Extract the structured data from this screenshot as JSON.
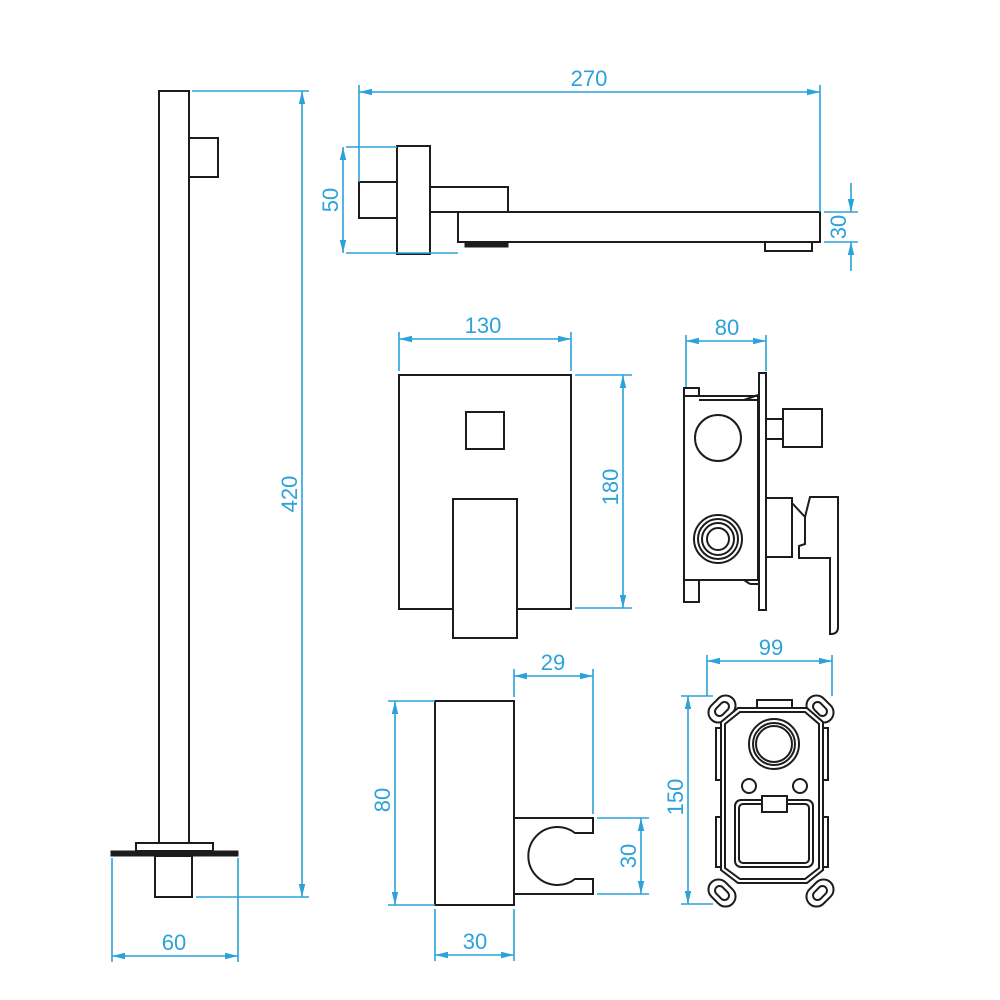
{
  "drawing": {
    "type": "technical-dimension-drawing",
    "subject": "concealed shower faucet set components",
    "units": "mm",
    "colors": {
      "part_line": "#1c1c1c",
      "dimension": "#2ba2d9",
      "background": "#ffffff"
    },
    "views": {
      "shower_arm": {
        "name": "ceiling shower arm side view",
        "dim_height": "420",
        "dim_base_width": "60"
      },
      "spout": {
        "name": "wall spout side view",
        "dim_length": "270",
        "dim_plate_height": "50",
        "dim_thickness": "30"
      },
      "mixer_front": {
        "name": "mixer trim front view",
        "dim_width": "130",
        "dim_height": "180"
      },
      "mixer_side": {
        "name": "mixer valve side view",
        "dim_depth": "80"
      },
      "holder": {
        "name": "hand shower holder side view",
        "dim_top_depth": "29",
        "dim_height": "80",
        "dim_clip_height": "30",
        "dim_base_depth": "30"
      },
      "rough_in_box": {
        "name": "rough-in valve box front view",
        "dim_width": "99",
        "dim_height": "150"
      }
    }
  }
}
